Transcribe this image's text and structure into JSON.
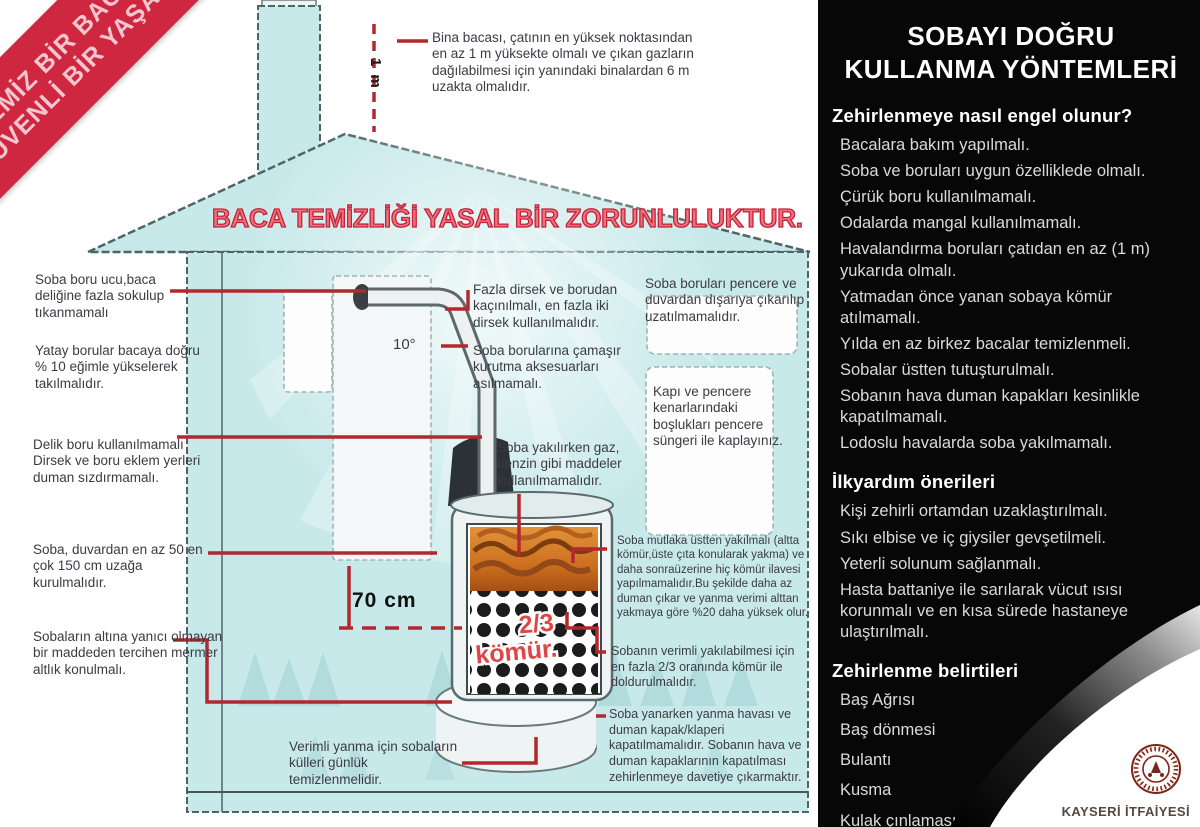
{
  "ribbon": {
    "line1": "TEMİZ BİR BACA",
    "line2": "GÜVENLİ BİR YAŞAM"
  },
  "banner": "BACA TEMİZLİĞİ YASAL BİR ZORUNLULUKTUR.",
  "measurements": {
    "chimney_height": "1 m",
    "pipe_angle": "10°",
    "wall_distance": "70 cm",
    "coal_level_line1": "2/3",
    "coal_level_line2": "kömür."
  },
  "annotations": {
    "chimney_top": "Bina bacası, çatının en yüksek noktasından en az 1 m yüksekte olmalı ve çıkan gazların dağılabilmesi için yanındaki binalardan 6 m uzakta olmalıdır.",
    "pipe_end": "Soba boru ucu,baca deliğine fazla sokulup tıkanmamalı",
    "horizontal_pipes": "Yatay borular bacaya doğru % 10 eğimle yükselerek takılmalıdır.",
    "no_holes": "Delik boru kullanılmamalı Dirsek ve boru eklem yerleri duman sızdırmamalı.",
    "wall_distance": "Soba, duvardan en az 50 en çok 150 cm uzağa kurulmalıdır.",
    "marble_base": "Sobaların altına yanıcı olmayan bir maddeden tercihen mermer altlık konulmalı.",
    "elbows": "Fazla dirsek ve borudan kaçınılmalı, en fazla iki dirsek kullanılmalıdır.",
    "no_laundry": "Soba borularına çamaşır kurutma aksesuarları asılmamalı.",
    "no_gas": "Soba yakılırken gaz, benzin gibi maddeler kullanılmamalıdır.",
    "pipes_window": "Soba boruları pencere ve  duvardan dışarıya çıkarılıp uzatılmamalıdır.",
    "window_foam": "Kapı ve pencere kenarlarındaki boşlukları pencere süngeri ile kaplayınız.",
    "top_burning": "Soba mutlaka üstten yakılmalı (altta kömür,üste çıta konularak yakma) ve daha sonraüzerine hiç kömür ilavesi yapılmamalıdır.Bu şekilde daha az duman çıkar ve yanma verimi alttan yakmaya göre %20 daha yüksek olur.",
    "coal_level": "Sobanın verimli yakılabilmesi için en fazla 2/3 oranında kömür ile doldurulmalıdır.",
    "dampers": "Soba yanarken yanma havası ve duman kapak/klaperi kapatılmamalıdır. Sobanın hava ve duman kapaklarının kapatılması zehirlenmeye davetiye çıkarmaktır.",
    "ash_cleaning": "Verimli yanma için sobaların külleri günlük temizlenmelidir."
  },
  "panel": {
    "title_line1": "SOBAYI DOĞRU",
    "title_line2": "KULLANMA YÖNTEMLERİ",
    "sections": [
      {
        "heading": "Zehirlenmeye nasıl engel olunur?",
        "items": [
          "Bacalara bakım yapılmalı.",
          "Soba ve boruları uygun özelliklede olmalı.",
          "Çürük boru kullanılmamalı.",
          "Odalarda mangal kullanılmamalı.",
          "Havalandırma boruları çatıdan en az (1 m) yukarıda olmalı.",
          "Yatmadan önce yanan sobaya kömür atılmamalı.",
          "Yılda en az birkez bacalar temizlenmeli.",
          "Sobalar üstten tutuşturulmalı.",
          "Sobanın hava duman kapakları kesinlikle kapatılmamalı.",
          "Lodoslu havalarda soba yakılmamalı."
        ]
      },
      {
        "heading": "İlkyardım önerileri",
        "items": [
          "Kişi zehirli ortamdan uzaklaştırılmalı.",
          "Sıkı elbise ve iç giysiler gevşetilmeli.",
          "Yeterli solunum sağlanmalı.",
          "Hasta battaniye ile sarılarak vücut ısısı korunmalı ve en kısa sürede hastaneye ulaştırılmalı."
        ]
      },
      {
        "heading": "Zehirlenme belirtileri",
        "items": [
          "Baş Ağrısı",
          "Baş dönmesi",
          "Bulantı",
          "Kusma",
          "Kulak çınlaması",
          "Yüz kızarması"
        ]
      }
    ],
    "footer": "KAYSERİ İTFAİYESİ"
  },
  "colors": {
    "ribbon_red": "#cf2740",
    "callout_red": "#b2282e",
    "house_fill": "#c8e9ea",
    "banner_red": "#e4505e",
    "panel_bg": "#070707",
    "logo_red": "#7c2418"
  }
}
